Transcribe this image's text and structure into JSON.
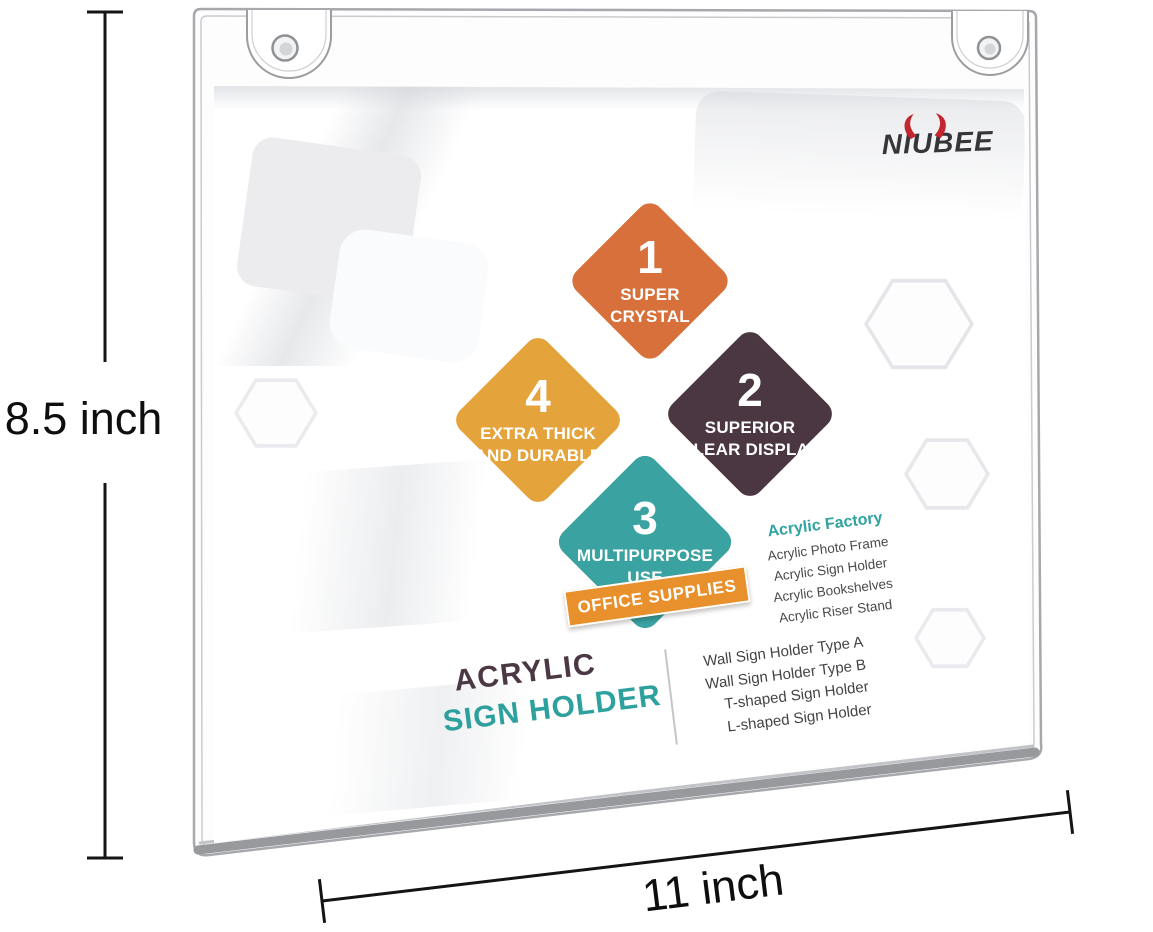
{
  "annotations": {
    "height_label": "8.5 inch",
    "width_label": "11 inch"
  },
  "logo": {
    "full": "NIUBEE",
    "text_left": "NI",
    "text_mid": "U",
    "text_right": "BEE",
    "horns_icon": "bull-horns",
    "text_color": "#35353A",
    "horns_color": "#C2262E"
  },
  "diamonds": [
    {
      "number": "1",
      "line1": "SUPER",
      "line2": "CRYSTAL",
      "color": "#D7703B"
    },
    {
      "number": "2",
      "line1": "SUPERIOR",
      "line2": "CLEAR  DISPLAY",
      "color": "#4A3741"
    },
    {
      "number": "3",
      "line1": "MULTIPURPOSE",
      "line2": "USE",
      "color": "#3AA2A0"
    },
    {
      "number": "4",
      "line1": "EXTRA  THICK",
      "line2": "AND  DURABLE",
      "color": "#E5A33C"
    }
  ],
  "banner": {
    "label": "OFFICE SUPPLIES",
    "bg_color": "#E8902C"
  },
  "factory": {
    "title": "Acrylic Factory",
    "title_color": "#2FA3A0",
    "items": [
      "Acrylic Photo Frame",
      "Acrylic Sign Holder",
      "Acrylic Bookshelves",
      "Acrylic Riser Stand"
    ]
  },
  "product_title": {
    "line1": "ACRYLIC",
    "line2": "SIGN HOLDER",
    "line1_color": "#4B3844",
    "line2_color": "#2EA19E"
  },
  "holder_types": {
    "items": [
      "Wall Sign Holder Type A",
      "Wall Sign Holder Type B",
      "T-shaped Sign Holder",
      "L-shaped Sign Holder"
    ]
  }
}
